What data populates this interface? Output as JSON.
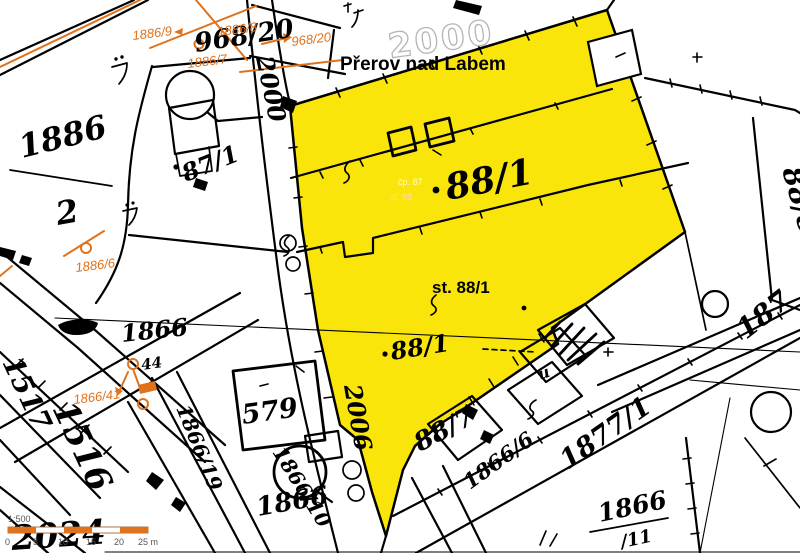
{
  "map": {
    "town_label": "Přerov nad Labem",
    "sheet_number": "2000",
    "selected_parcel": {
      "number": "88/1",
      "building_label": "st. 88/1"
    },
    "colors": {
      "highlight": "#fae50a",
      "annotation": "#e0721c",
      "ink": "#000000"
    },
    "labels": {
      "hw_968_20": "968/20",
      "town": "Přerov nad Labem",
      "sheet": "2000",
      "fr1886_num": "1886",
      "fr1886_den": "2",
      "p87_1": "87/1",
      "p88_1": "88/1",
      "faint1": "čp. 87",
      "faint2": "st. 88",
      "st88": "st. 88/1",
      "p88_1_small": "88/1",
      "road2000": "2000",
      "road2006": "2006",
      "p1866_mid": "1866",
      "p44": "44",
      "p579": "579",
      "p1866_19": "1866/19",
      "p1866_10": "1866/10",
      "p1866_low": "1866",
      "p88_7": "88/7",
      "p1866_6": "1866/6",
      "p1877_1": "1877/1",
      "fr1866_num": "1866",
      "fr1866_den": "/11",
      "p1516": "1516",
      "p1517": "1517",
      "p2024": "2024",
      "p88_8": "88/8",
      "p187": "187",
      "sym_u": "u"
    },
    "orange_labels": {
      "a": "1886/9",
      "b": "1886/8",
      "c": "968/20",
      "d": "1886/7",
      "e": "1886/6",
      "f": "1866/41"
    },
    "scale_bar": {
      "ratio": "1:500",
      "ticks": [
        "0",
        "5",
        "10",
        "15",
        "20",
        "25 m"
      ]
    }
  }
}
